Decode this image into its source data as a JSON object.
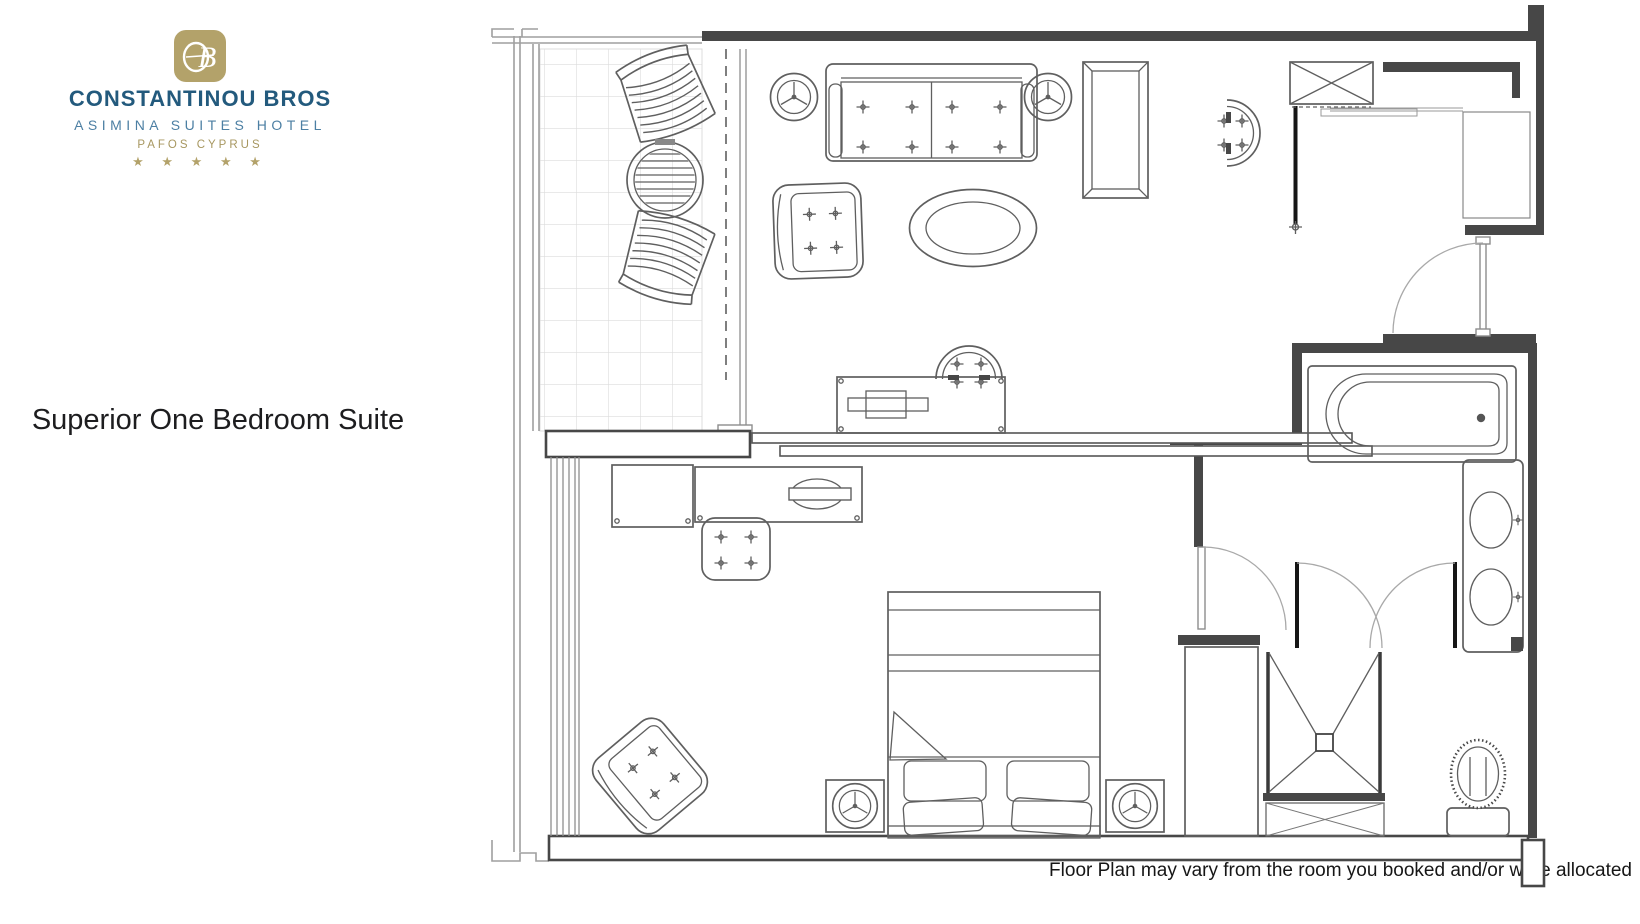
{
  "page": {
    "background": "#ffffff"
  },
  "logo": {
    "monogram": "CB",
    "monogram_bg": "#b3a26a",
    "line1": "CONSTANTINOU BROS",
    "line1_color": "#235a7d",
    "line2": "ASIMINA SUITES HOTEL",
    "line2_color": "#4c7fa3",
    "line3": "PAFOS CYPRUS",
    "line3_color": "#a79760",
    "stars": "★ ★ ★ ★ ★",
    "stars_color": "#b3a26a"
  },
  "title": {
    "text": "Superior One Bedroom Suite",
    "color": "#1d1d1f"
  },
  "disclaimer": {
    "text": "Floor Plan may vary from the room you booked and/or were allocated",
    "color": "#161616"
  },
  "floor_plan": {
    "wall_color": "#474747",
    "furniture_color": "#5f5f5f",
    "balcony_tile_color": "#dcdcdc",
    "rooms": [
      "balcony",
      "living-room",
      "bedroom",
      "entry",
      "hallway",
      "bathroom",
      "shower-area",
      "wc-area"
    ],
    "furniture": [
      "lounge-chair",
      "lounge-chair",
      "balcony-round-table",
      "sofa",
      "side-table",
      "side-table",
      "armchair",
      "oval-coffee-table",
      "writing-desk",
      "desk-chair",
      "tv-cabinet",
      "cabinet-chair",
      "wardrobe",
      "double-bed",
      "pillows",
      "nightstand",
      "nightstand",
      "table-lamp",
      "table-lamp",
      "bedroom-armchair",
      "tv-console",
      "luggage-bench",
      "side-table",
      "bathtub",
      "double-sink-vanity",
      "walk-in-shower",
      "toilet",
      "closet"
    ]
  }
}
